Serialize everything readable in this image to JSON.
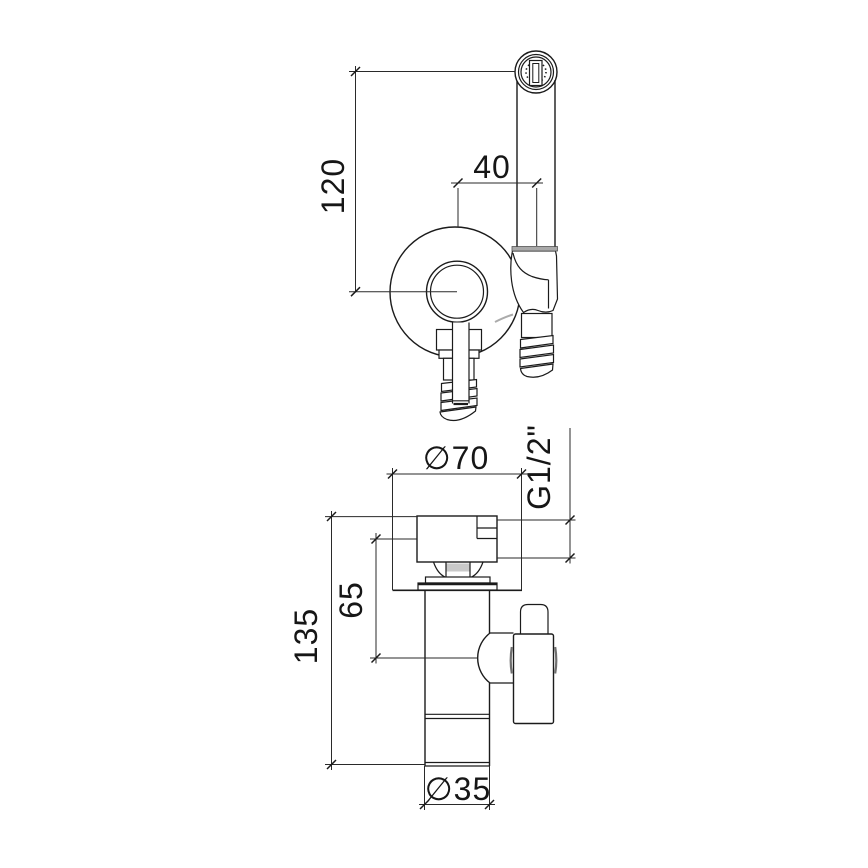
{
  "page": {
    "background": "#ffffff",
    "line_color": "#1b1b1b",
    "shade_color": "#a9a9a9"
  },
  "drawing": {
    "type": "technical-dimension-drawing",
    "subject": "wall-mounted bidet shower mixer with hand spray and shut-off valve",
    "views": [
      {
        "id": "front-view",
        "name": "front view: spray head, handle, wall plate, holder, hose and inlet connectors"
      },
      {
        "id": "side-view",
        "name": "side view: valve body, flange, outlet pipe, lever handle"
      }
    ],
    "dimensions": {
      "head_height": {
        "label": "120"
      },
      "head_offset": {
        "label": "40"
      },
      "plate_diameter": {
        "label": "∅70"
      },
      "thread_size": {
        "label": "G1/2\""
      },
      "depth_to_axis": {
        "label": "65"
      },
      "overall_depth": {
        "label": "135"
      },
      "outlet_diameter": {
        "label": "∅35"
      }
    }
  }
}
